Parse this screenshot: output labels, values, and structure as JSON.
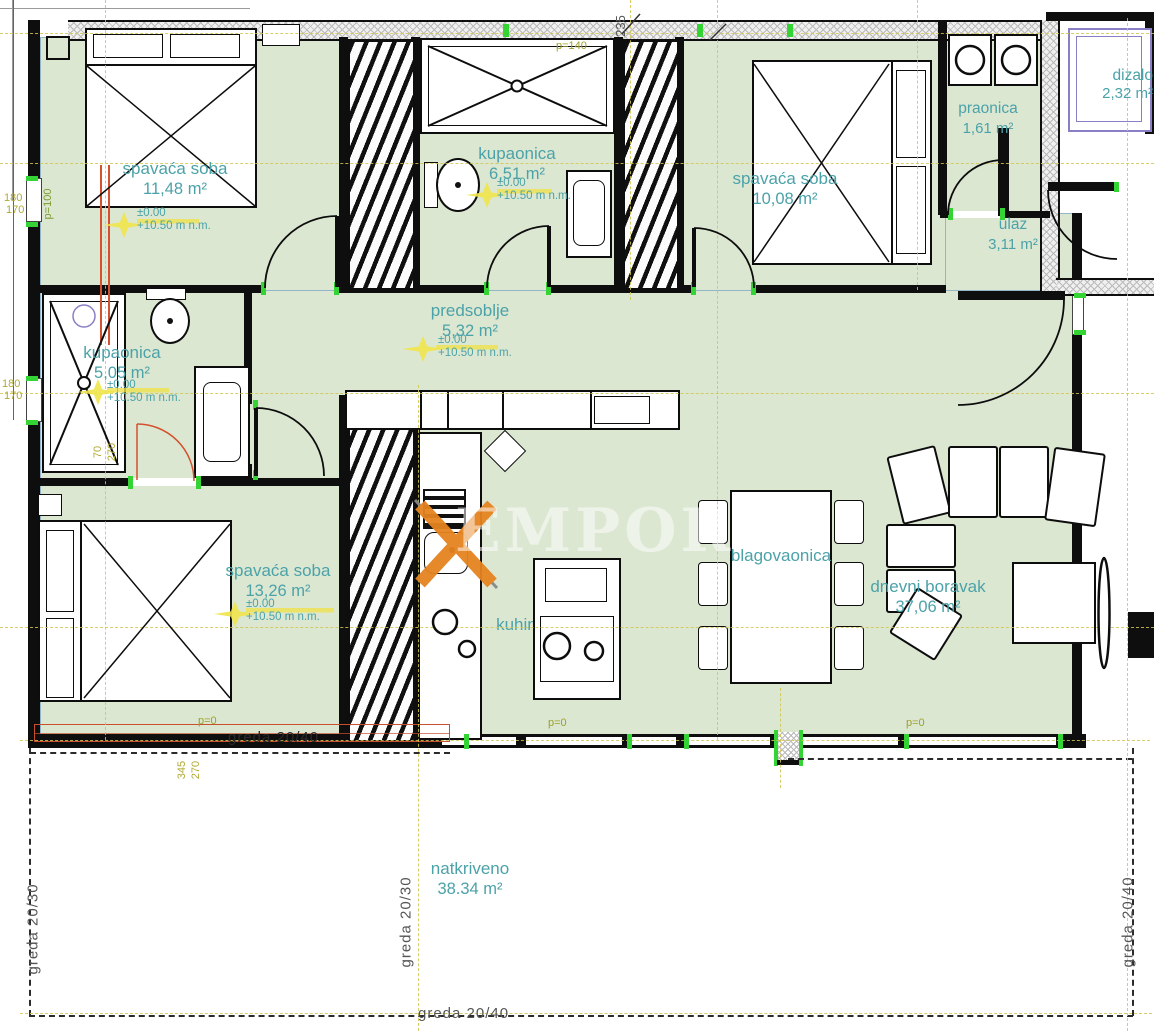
{
  "colors": {
    "room_fill": "#dce7d2",
    "label_teal": "#4ba2a8",
    "axis_yellow": "#d2c64f",
    "dim_olive": "#b0aa33",
    "accent_green": "#35d435",
    "beam_red": "#c9502e",
    "purple": "#8a7fc5",
    "logo_orange": "#e5831f",
    "wall": "#0e0e0e"
  },
  "rooms": [
    {
      "id": "bedroom-1",
      "name": "spavaća soba",
      "area": "11,48 m²",
      "elev": "±0.00",
      "nm": "+10.50 m n.m."
    },
    {
      "id": "bathroom-top",
      "name": "kupaonica",
      "area": "6,51 m²",
      "elev": "±0.00",
      "nm": "+10.50 m n.m."
    },
    {
      "id": "bedroom-2",
      "name": "spavaća soba",
      "area": "10,08 m²"
    },
    {
      "id": "laundry",
      "name": "praonica",
      "area": "1,61 m²"
    },
    {
      "id": "entry",
      "name": "ulaz",
      "area": "3,11 m²"
    },
    {
      "id": "elevator",
      "name": "dizalo",
      "area": "2,32 m²"
    },
    {
      "id": "hallway",
      "name": "predsoblje",
      "area": "5,32 m²",
      "elev": "±0.00",
      "nm": "+10.50 m n.m."
    },
    {
      "id": "bathroom-left",
      "name": "kupaonica",
      "area": "5,05 m²",
      "elev": "±0.00",
      "nm": "+10.50 m n.m."
    },
    {
      "id": "bedroom-3",
      "name": "spavaća soba",
      "area": "13,26 m²",
      "elev": "±0.00",
      "nm": "+10.50 m n.m."
    },
    {
      "id": "kitchen",
      "name": "kuhinja"
    },
    {
      "id": "dining",
      "name": "blagovaonica"
    },
    {
      "id": "living",
      "name": "dnevni boravak",
      "area": "37,06 m²"
    },
    {
      "id": "terrace",
      "name": "natkriveno",
      "area": "38.34 m²"
    }
  ],
  "beams": {
    "top": "greda 20/40",
    "bottom": "greda 20/40",
    "left": "greda 20/30",
    "middle": "greda 20/30",
    "right": "greda 20/40"
  },
  "dims": {
    "n235": "235",
    "n180a": "180",
    "n170a": "170",
    "n180b": "180",
    "n170b": "170",
    "n345": "345",
    "n270a": "270",
    "n70": "70",
    "n270b": "270",
    "p100": "p=100",
    "p140": "p=140",
    "p0a": "p=0",
    "p0b": "p=0",
    "p0c": "p=0"
  },
  "watermark": {
    "text": "EMPORIO"
  }
}
